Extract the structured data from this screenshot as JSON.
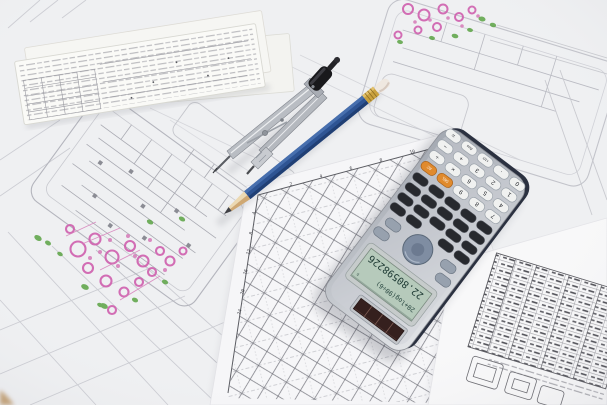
{
  "scene": {
    "title": "Engineering drawings with drafting compass, pencil and scientific calculator",
    "setting": "technical blueprints spread on a desk"
  },
  "calculator": {
    "display": {
      "expression": "20+log(90÷6)",
      "result": "22.80598226",
      "mode_indicator": "D"
    },
    "keys": {
      "white_rows": [
        [
          "7",
          "8",
          "9",
          "DEL",
          "AC"
        ],
        [
          "4",
          "5",
          "6",
          "×",
          "÷"
        ],
        [
          "1",
          "2",
          "3",
          "+",
          "−"
        ],
        [
          "0",
          "·",
          "×10ˣ",
          "Ans",
          "="
        ]
      ]
    },
    "colors": {
      "body": "#c3c7cd",
      "edge": "#2b3140",
      "lcd": "#b6cabb",
      "solar_panel": "#35201e",
      "key_dark": "#27292e",
      "key_light": "#f0f1f0",
      "key_orange": "#e08a2d",
      "nav_pad": "#7f8da2"
    }
  },
  "chart": {
    "left_tick_labels": [
      "4",
      "8",
      "12",
      "16",
      "20",
      "24"
    ],
    "top_tick_labels": [
      "2",
      "4",
      "6",
      "8",
      "10"
    ]
  },
  "annotations": {
    "pink": "#cf5fae",
    "green": "#5ba344"
  },
  "tools": {
    "pencil_color": "#2e5493",
    "compass_grip": "#19191c"
  }
}
